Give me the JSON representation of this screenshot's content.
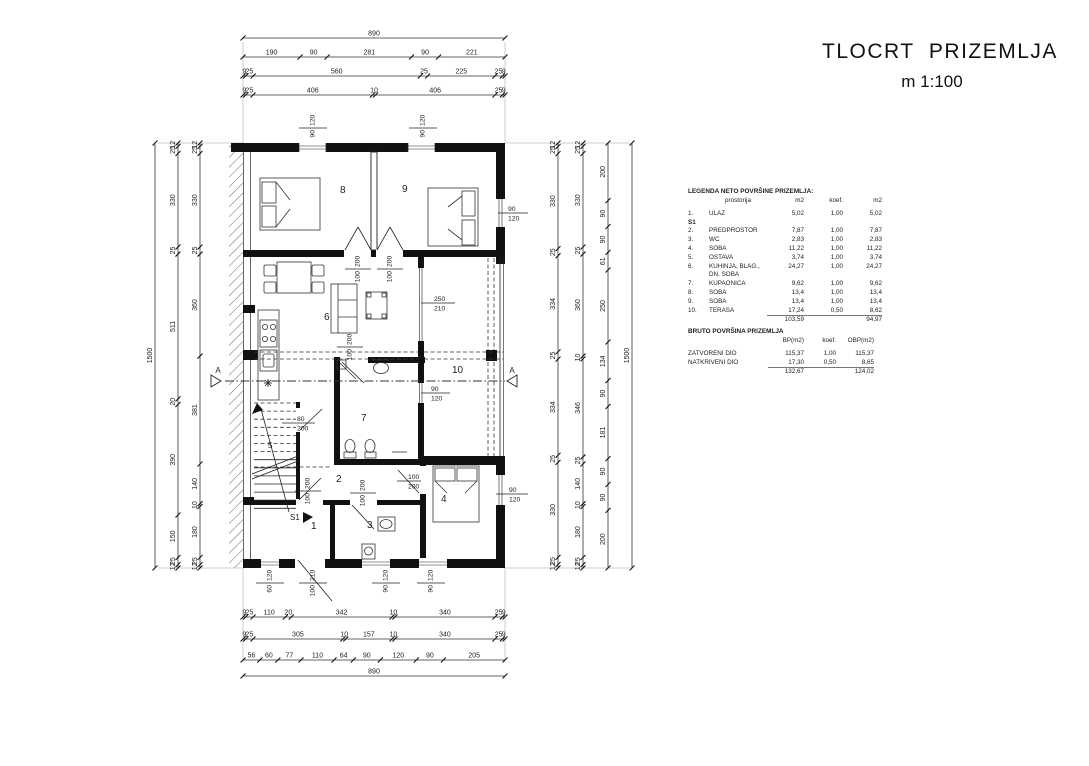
{
  "title": {
    "line1": "TLOCRT  PRIZEMLJA",
    "line2": "m 1:100"
  },
  "legend": {
    "heading": "LEGENDA NETO POVRŠINE PRIZEMLJA:",
    "columns": [
      "prostorija",
      "m2",
      "koef.",
      "m2"
    ],
    "rows": [
      {
        "num": "1.",
        "name": "ULAZ",
        "m2": "5,02",
        "koef": "1,00",
        "m2b": "5,02"
      },
      {
        "num": "S1",
        "name": "",
        "m2": "",
        "koef": "",
        "m2b": "",
        "bold": true
      },
      {
        "num": "2.",
        "name": "PREDPROSTOR",
        "m2": "7,87",
        "koef": "1,00",
        "m2b": "7,87"
      },
      {
        "num": "3.",
        "name": "WC",
        "m2": "2,83",
        "koef": "1,00",
        "m2b": "2,83"
      },
      {
        "num": "4.",
        "name": "SOBA",
        "m2": "11,22",
        "koef": "1,00",
        "m2b": "11,22"
      },
      {
        "num": "5.",
        "name": "OSTAVA",
        "m2": "3,74",
        "koef": "1,00",
        "m2b": "3,74"
      },
      {
        "num": "6.",
        "name": "KUHINJA, BLAG., DN. SOBA",
        "m2": "24,27",
        "koef": "1,00",
        "m2b": "24,27"
      },
      {
        "num": "7.",
        "name": "KUPAONICA",
        "m2": "9,62",
        "koef": "1,00",
        "m2b": "9,62"
      },
      {
        "num": "8.",
        "name": "SOBA",
        "m2": "13,4",
        "koef": "1,00",
        "m2b": "13,4"
      },
      {
        "num": "9.",
        "name": "SOBA",
        "m2": "13,4",
        "koef": "1,00",
        "m2b": "13,4"
      },
      {
        "num": "10.",
        "name": "TERASA",
        "m2": "17,24",
        "koef": "0,50",
        "m2b": "8,62"
      }
    ],
    "total_m2": "103,59",
    "total_m2b": "94,97"
  },
  "bruto": {
    "heading": "BRUTO POVRŠINA PRIZEMLJA",
    "columns": [
      "BP(m2)",
      "koef.",
      "OBP(m2)"
    ],
    "rows": [
      {
        "name": "ZATVORENI DIO",
        "bp": "115,37",
        "koef": "1,00",
        "obp": "115,37"
      },
      {
        "name": "NATKRIVENI DIO",
        "bp": "17,30",
        "koef": "0,50",
        "obp": "8,65"
      }
    ],
    "total_bp": "132,67",
    "total_obp": "124,02"
  },
  "rooms": {
    "r1": "1",
    "r2": "2",
    "r3": "3",
    "r4": "4",
    "r5": "5",
    "r6": "6",
    "r7": "7",
    "r8": "8",
    "r9": "9",
    "r10": "10",
    "stair_mark": "S1",
    "section_letter": "A"
  },
  "openings": {
    "top_window_1": {
      "w": "90",
      "h": "120"
    },
    "top_window_2": {
      "w": "90",
      "h": "120"
    },
    "room9_window": {
      "w": "90",
      "h": "120"
    },
    "terrace_door": {
      "w": "250",
      "h": "210"
    },
    "bath_window": {
      "w": "90",
      "h": "120"
    },
    "storage_door": {
      "w": "80",
      "h": "200"
    },
    "room8_door": {
      "w": "100",
      "h": "200"
    },
    "room9_door": {
      "w": "100",
      "h": "200"
    },
    "bath_door": {
      "w": "100",
      "h": "200"
    },
    "room1_door": {
      "w": "100",
      "h": "200"
    },
    "wc_door": {
      "w": "100",
      "h": "200"
    },
    "room4_door": {
      "w": "100",
      "h": "200"
    },
    "room4_window": {
      "w": "90",
      "h": "120"
    },
    "bottom_window_1": {
      "w": "60",
      "h": "120"
    },
    "entry_door": {
      "w": "100",
      "h": "210"
    },
    "wc_window": {
      "w": "90",
      "h": "120"
    },
    "room4_bottom_window": {
      "w": "90",
      "h": "120"
    }
  },
  "dims": {
    "top": [
      [
        "890"
      ],
      [
        "190",
        "90",
        "281",
        "90",
        "221"
      ],
      [
        "9",
        "25",
        "560",
        "25",
        "225",
        "25",
        "9"
      ],
      [
        "9",
        "25",
        "406",
        "10",
        "406",
        "25",
        "9"
      ]
    ],
    "bottom": [
      [
        "9",
        "25",
        "110",
        "20",
        "342",
        "10",
        "340",
        "25",
        "9"
      ],
      [
        "9",
        "25",
        "305",
        "10",
        "157",
        "10",
        "340",
        "25",
        "9"
      ],
      [
        "56",
        "60",
        "77",
        "110",
        "64",
        "90",
        "120",
        "90",
        "205"
      ],
      [
        "890"
      ]
    ],
    "left": [
      [
        "1500"
      ],
      [
        "12",
        "25",
        "330",
        "25",
        "511",
        "20",
        "390",
        "150",
        "25",
        "12"
      ],
      [
        "12",
        "25",
        "330",
        "25",
        "360",
        "381",
        "140",
        "10",
        "180",
        "25",
        "12"
      ]
    ],
    "right": [
      [
        "12",
        "25",
        "330",
        "25",
        "334",
        "25",
        "334",
        "25",
        "330",
        "25",
        "12"
      ],
      [
        "12",
        "25",
        "330",
        "25",
        "360",
        "10",
        "346",
        "25",
        "140",
        "10",
        "180",
        "25",
        "12"
      ],
      [
        "200",
        "90",
        "90",
        "61",
        "250",
        "134",
        "90",
        "181",
        "90",
        "90",
        "200"
      ],
      [
        "1500"
      ]
    ]
  }
}
